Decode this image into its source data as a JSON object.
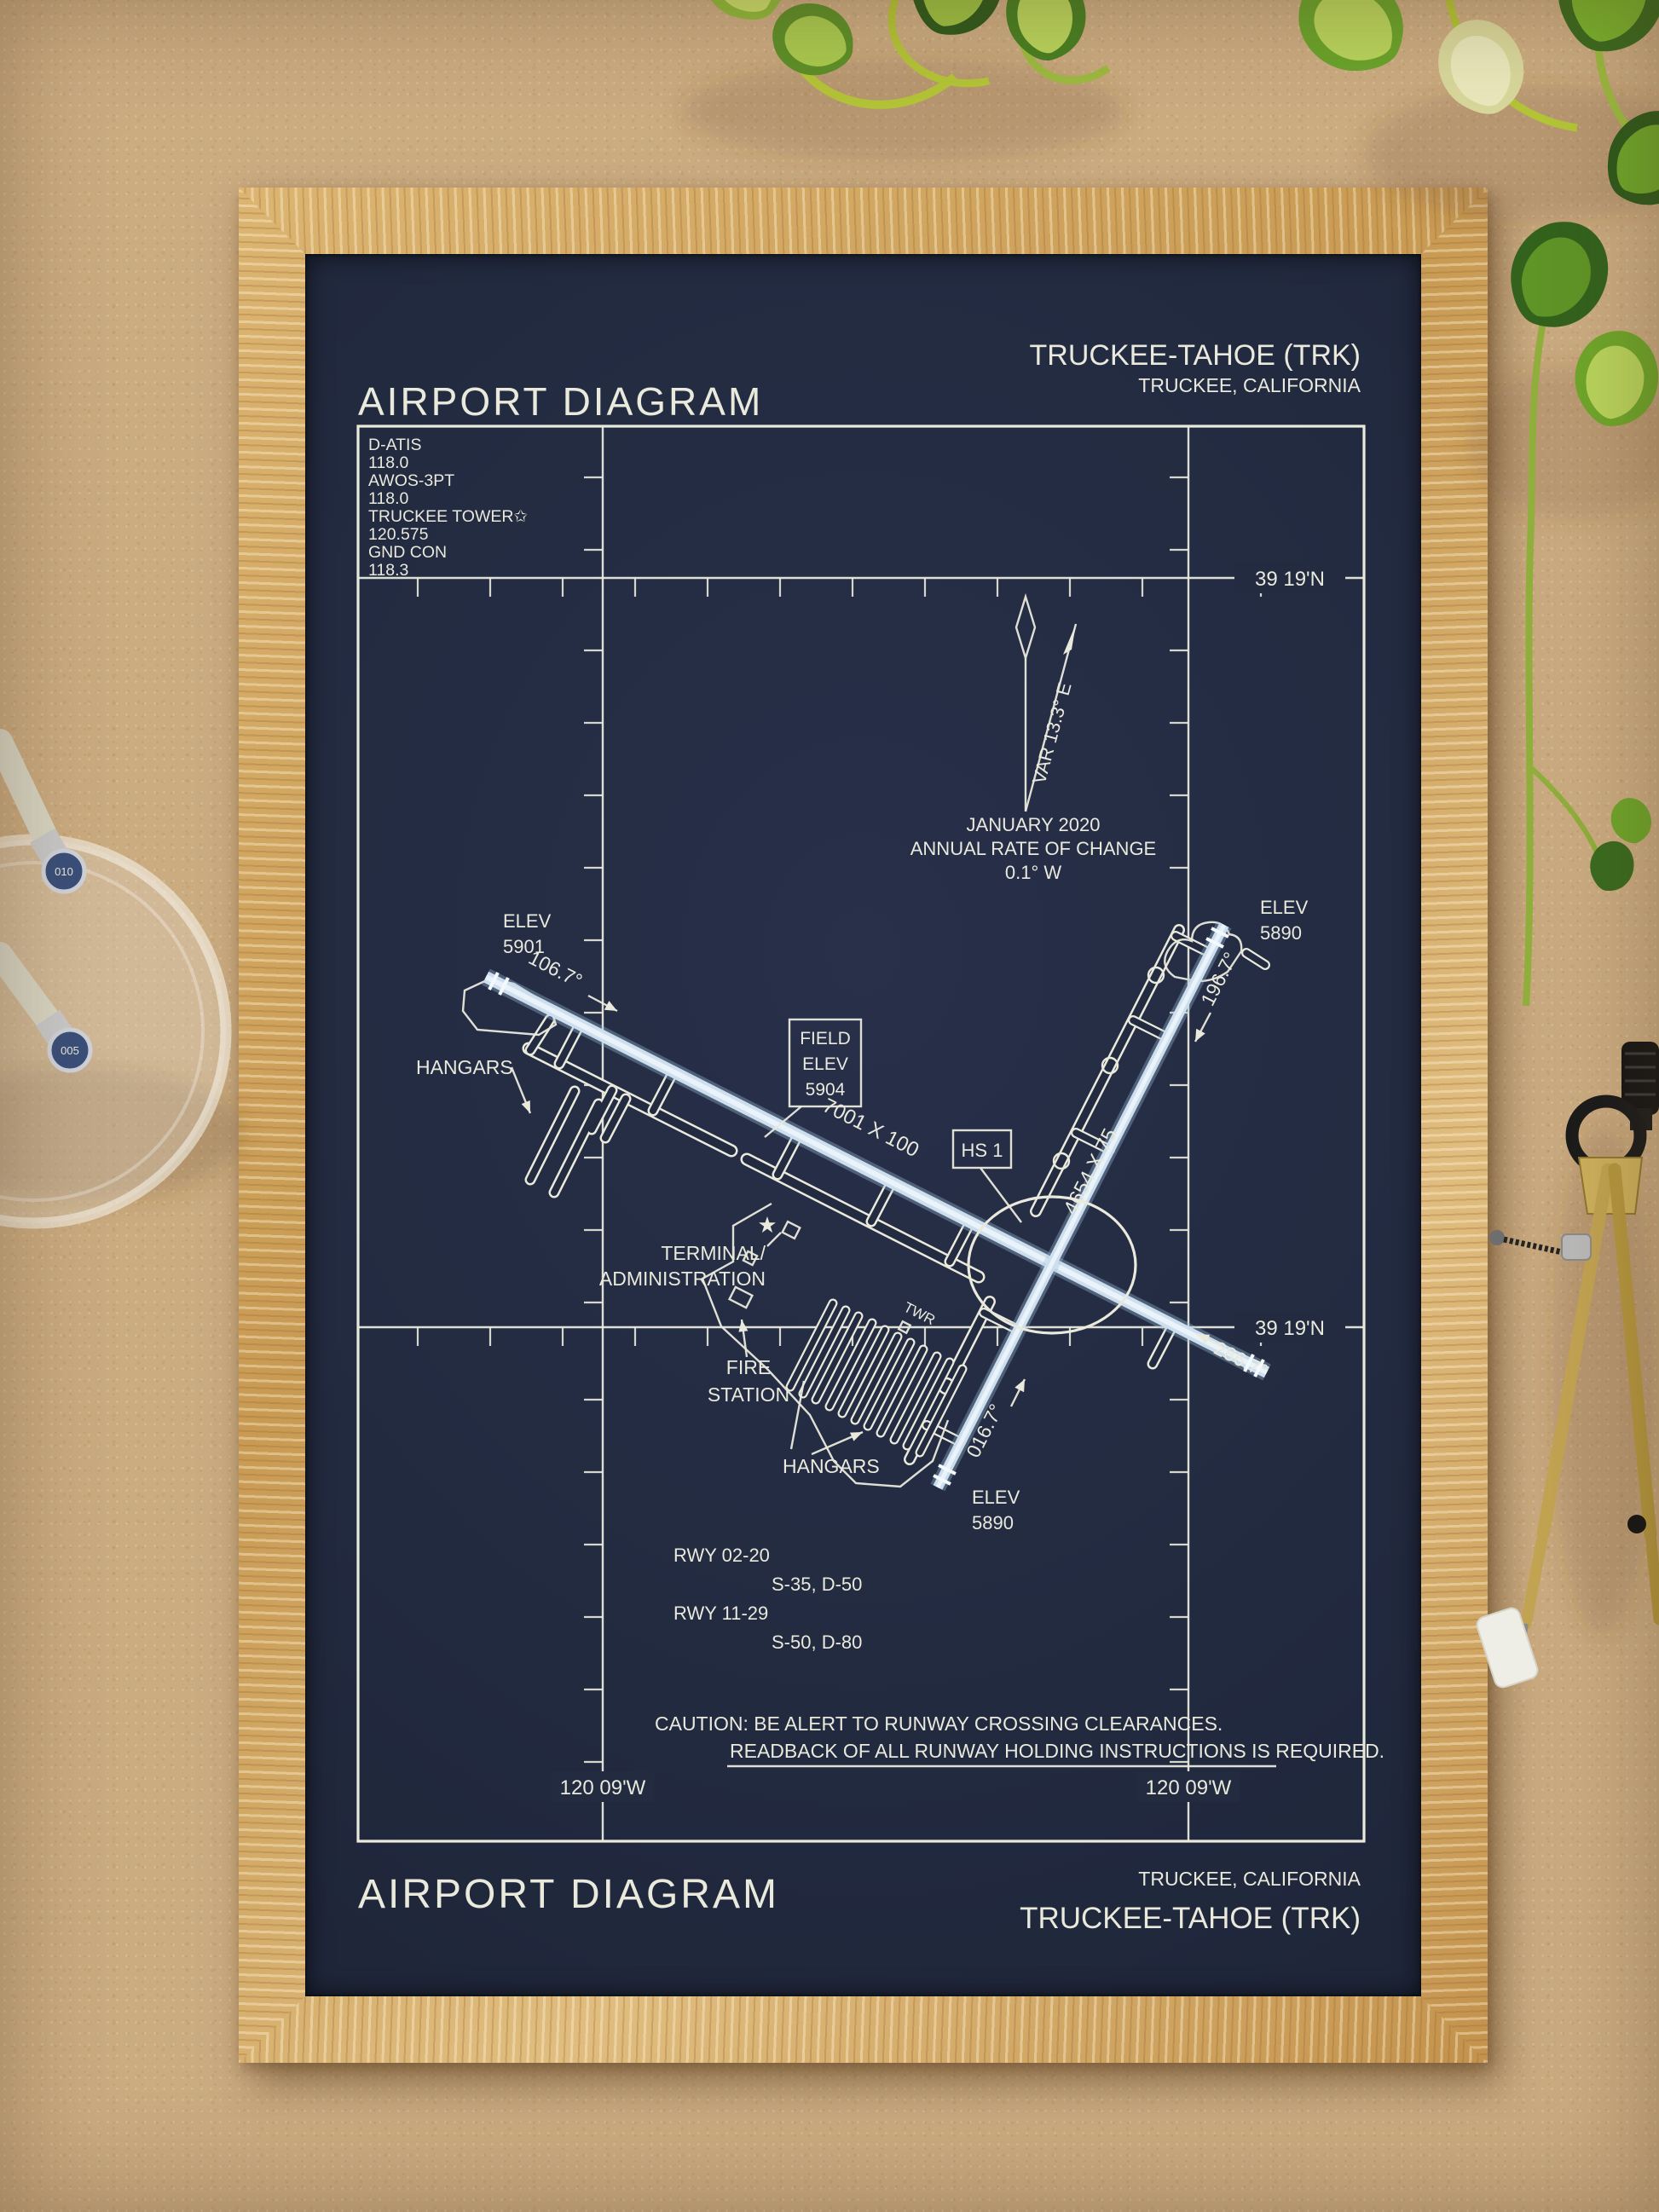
{
  "colors": {
    "cork": "#cbab80",
    "poster": "#232b41",
    "ink": "#e9e9dc",
    "runway": "#cddfee",
    "leafd": "#2f5a1c",
    "leafl": "#a9c838",
    "stem": "#b3c437",
    "brass": "#c2a352"
  },
  "header": {
    "title": "AIRPORT DIAGRAM",
    "airport": "TRUCKEE-TAHOE (TRK)",
    "city": "TRUCKEE, CALIFORNIA"
  },
  "footer": {
    "title": "AIRPORT DIAGRAM",
    "city": "TRUCKEE, CALIFORNIA",
    "airport": "TRUCKEE-TAHOE (TRK)"
  },
  "comm": [
    "D-ATIS",
    "118.0",
    "AWOS-3PT",
    "118.0",
    "TRUCKEE TOWER✩",
    "120.575",
    "GND CON",
    "118.3"
  ],
  "grid": {
    "lat_top": "39 19'N",
    "lat_bottom": "39 19'N",
    "lon_left": "120 09'W",
    "lon_right": "120 09'W"
  },
  "rose": {
    "variation": "VAR 13.3° E",
    "date": "JANUARY 2020",
    "rate_label": "ANNUAL RATE OF CHANGE",
    "rate": "0.1° W"
  },
  "rwy": {
    "r1129": {
      "dim": "7001 X 100",
      "h11": "106.7°",
      "h29": "286.7°"
    },
    "r0220": {
      "dim": "4654 X 75",
      "h02": "016.7°",
      "h20": "196.7°"
    }
  },
  "elev": {
    "nw": [
      "ELEV",
      "5901"
    ],
    "ne": [
      "ELEV",
      "5890"
    ],
    "s": [
      "ELEV",
      "5890"
    ],
    "field": [
      "FIELD",
      "ELEV",
      "5904"
    ]
  },
  "hotspot": {
    "label": "HS 1"
  },
  "gl": {
    "hangars_nw": "HANGARS",
    "hangars_s": "HANGARS",
    "terminal_1": "TERMINAL/",
    "terminal_2": "ADMINISTRATION",
    "fire_1": "FIRE",
    "fire_2": "STATION",
    "twr": "TWR"
  },
  "rwy_data": [
    "RWY 02-20",
    "S-35, D-50",
    "RWY 11-29",
    "S-50, D-80"
  ],
  "caution": {
    "line1": "CAUTION: BE ALERT TO RUNWAY CROSSING CLEARANCES.",
    "line2": "READBACK OF ALL RUNWAY HOLDING INSTRUCTIONS IS REQUIRED."
  },
  "pens": {
    "cap_large": "010",
    "cap_small": "005"
  }
}
